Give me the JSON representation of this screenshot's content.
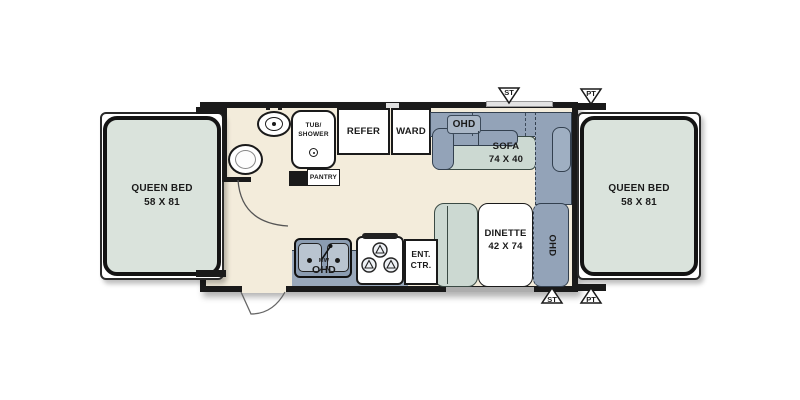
{
  "floorplan": {
    "type": "travel-trailer-floorplan",
    "colors": {
      "floor": "#f3ecdb",
      "wall": "#1a1a1a",
      "bed": "#dae3dc",
      "cushion_teal": "#ccd9d2",
      "cabinet_blue": "#93a3b8",
      "fixture_white": "#ffffff"
    },
    "beds": {
      "left": {
        "line1": "QUEEN BED",
        "line2": "58 X 81"
      },
      "right": {
        "line1": "QUEEN BED",
        "line2": "58 X 81"
      }
    },
    "bathroom": {
      "tub": {
        "line1": "TUB/",
        "line2": "SHOWER"
      },
      "pantry": "PANTRY"
    },
    "storage": {
      "refer": "REFER",
      "ward": "WARD"
    },
    "sofa": {
      "ohd": "OHD",
      "line1": "SOFA",
      "line2": "74 X 40"
    },
    "dinette": {
      "line1": "DINETTE",
      "line2": "42 X 74",
      "ohd": "OHD"
    },
    "kitchen": {
      "mw": "MW",
      "ohd": "OHD",
      "ent": {
        "line1": "ENT.",
        "line2": "CTR."
      }
    },
    "markers": {
      "top_st": "ST",
      "top_pt": "PT",
      "bottom_st": "ST",
      "bottom_pt": "PT"
    }
  }
}
